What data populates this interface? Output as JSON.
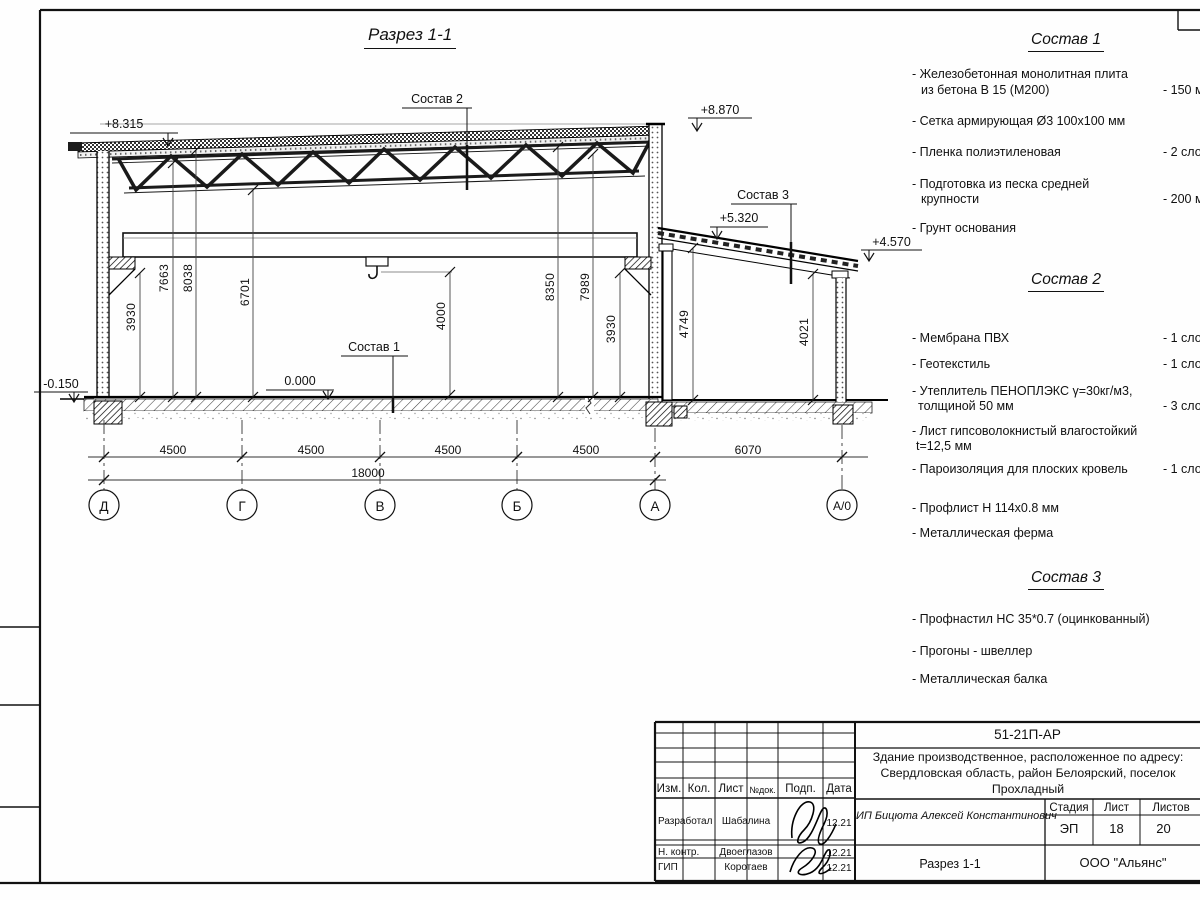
{
  "drawing": {
    "title": "Разрез 1-1",
    "elevations": {
      "roof_left": "+8.315",
      "parapet_right": "+8.870",
      "annex_high": "+5.320",
      "annex_low": "+4.570",
      "floor_zero": "0.000",
      "ground": "-0.150"
    },
    "leaders": {
      "s1": "Состав 1",
      "s2": "Состав 2",
      "s3": "Состав 3"
    },
    "vdims": {
      "v3930l": "3930",
      "v7663": "7663",
      "v8038": "8038",
      "v6701": "6701",
      "v4000": "4000",
      "v8350": "8350",
      "v7989": "7989",
      "v3930r": "3930",
      "v4749": "4749",
      "v4021": "4021"
    },
    "hdims": {
      "span1": "4500",
      "span2": "4500",
      "span3": "4500",
      "span4": "4500",
      "span5": "6070",
      "total": "18000"
    },
    "axes": [
      "Д",
      "Г",
      "В",
      "Б",
      "А",
      "А/0"
    ]
  },
  "specs": {
    "s1": {
      "title": "Состав 1",
      "items": [
        {
          "lines": [
            "- Железобетонная  монолитная плита",
            "из бетона В 15 (М200)"
          ],
          "qty": "- 150 м"
        },
        {
          "lines": [
            "- Сетка армирующая Ø3 100х100 мм"
          ],
          "qty": ""
        },
        {
          "lines": [
            "- Пленка полиэтиленовая"
          ],
          "qty": "- 2 сло"
        },
        {
          "lines": [
            "- Подготовка из песка средней",
            "крупности"
          ],
          "qty": "- 200 м"
        },
        {
          "lines": [
            "- Грунт основания"
          ],
          "qty": ""
        }
      ]
    },
    "s2": {
      "title": "Состав 2",
      "items": [
        {
          "lines": [
            "- Мембрана ПВХ"
          ],
          "qty": "- 1 сло"
        },
        {
          "lines": [
            "- Геотекстиль"
          ],
          "qty": "- 1 сло"
        },
        {
          "lines": [
            "- Утеплитель ПЕНОПЛЭКС γ=30кг/м3,",
            "толщиной 50 мм"
          ],
          "qty": "- 3 сло"
        },
        {
          "lines": [
            "- Лист гипсоволокнистый влагостойкий",
            "t=12,5 мм"
          ],
          "qty": ""
        },
        {
          "lines": [
            "- Пароизоляция для плоских кровель"
          ],
          "qty": "- 1 сло"
        },
        {
          "lines": [
            "- Профлист Н 114х0.8 мм"
          ],
          "qty": ""
        },
        {
          "lines": [
            "- Металлическая ферма"
          ],
          "qty": ""
        }
      ]
    },
    "s3": {
      "title": "Состав 3",
      "items": [
        {
          "lines": [
            "- Профнастил НС 35*0.7 (оцинкованный)"
          ],
          "qty": ""
        },
        {
          "lines": [
            "- Прогоны - швеллер"
          ],
          "qty": ""
        },
        {
          "lines": [
            "- Металлическая балка"
          ],
          "qty": ""
        }
      ]
    }
  },
  "title_block": {
    "doc_number": "51-21П-АР",
    "project_lines": [
      "Здание производственное, расположенное по адресу:",
      "Свердловская область, район Белоярский, поселок",
      "Прохладный"
    ],
    "columns": [
      "Изм.",
      "Кол.",
      "Лист",
      "№док.",
      "Подп.",
      "Дата"
    ],
    "rows": [
      {
        "role": "Разработал",
        "name": "Шабалина",
        "date": "12.21"
      },
      {
        "role": "Н. контр.",
        "name": "Двоеглазов",
        "date": "12.21"
      },
      {
        "role": "ГИП",
        "name": "Коротаев",
        "date": "12.21"
      }
    ],
    "client": "ИП Бицюта Алексей Константинович",
    "stage_label": "Стадия",
    "sheet_label": "Лист",
    "sheets_label": "Листов",
    "stage": "ЭП",
    "sheet": "18",
    "sheets": "20",
    "sheet_title": "Разрез 1-1",
    "company": "ООО \"Альянс\""
  }
}
